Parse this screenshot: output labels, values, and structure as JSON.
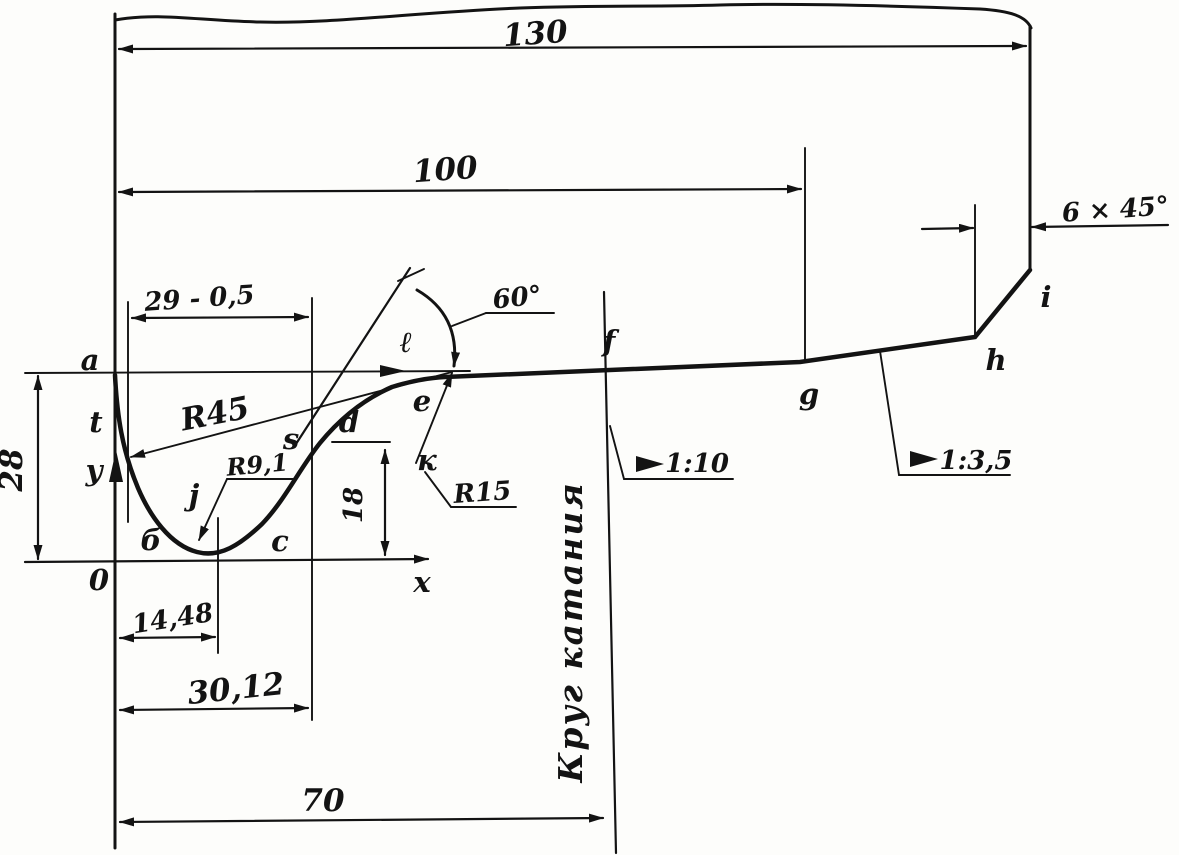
{
  "drawing": {
    "kind": "hand-drawn wheel profile engineering sketch",
    "ink_color": "#131313",
    "paper_color": "#fdfdfb",
    "dims": {
      "total_width": "130",
      "to_rolling_circle": "100",
      "chamfer": "6 × 45°",
      "flange_top_width": "29 - 0,5",
      "flange_angle": "60°",
      "flange_height": "28",
      "d_height": "18",
      "apex_offset": "14,48",
      "flange_full_width": "30,12",
      "rolling_circle_offset": "70"
    },
    "radii": {
      "outer_flange": "R45",
      "root": "R9,1",
      "throat": "R15"
    },
    "tapers": {
      "tread": "1:10",
      "rim": "1:3,5"
    },
    "note_rolling_circle": "Круг катания",
    "points": {
      "a": "a",
      "b": "б",
      "c": "c",
      "d": "d",
      "e": "e",
      "f": "f",
      "g": "g",
      "h": "h",
      "i": "i",
      "j": "j",
      "k": "к",
      "l": "ℓ",
      "s": "s",
      "t": "t"
    },
    "axes": {
      "x": "x",
      "y": "y",
      "origin": "0"
    }
  }
}
